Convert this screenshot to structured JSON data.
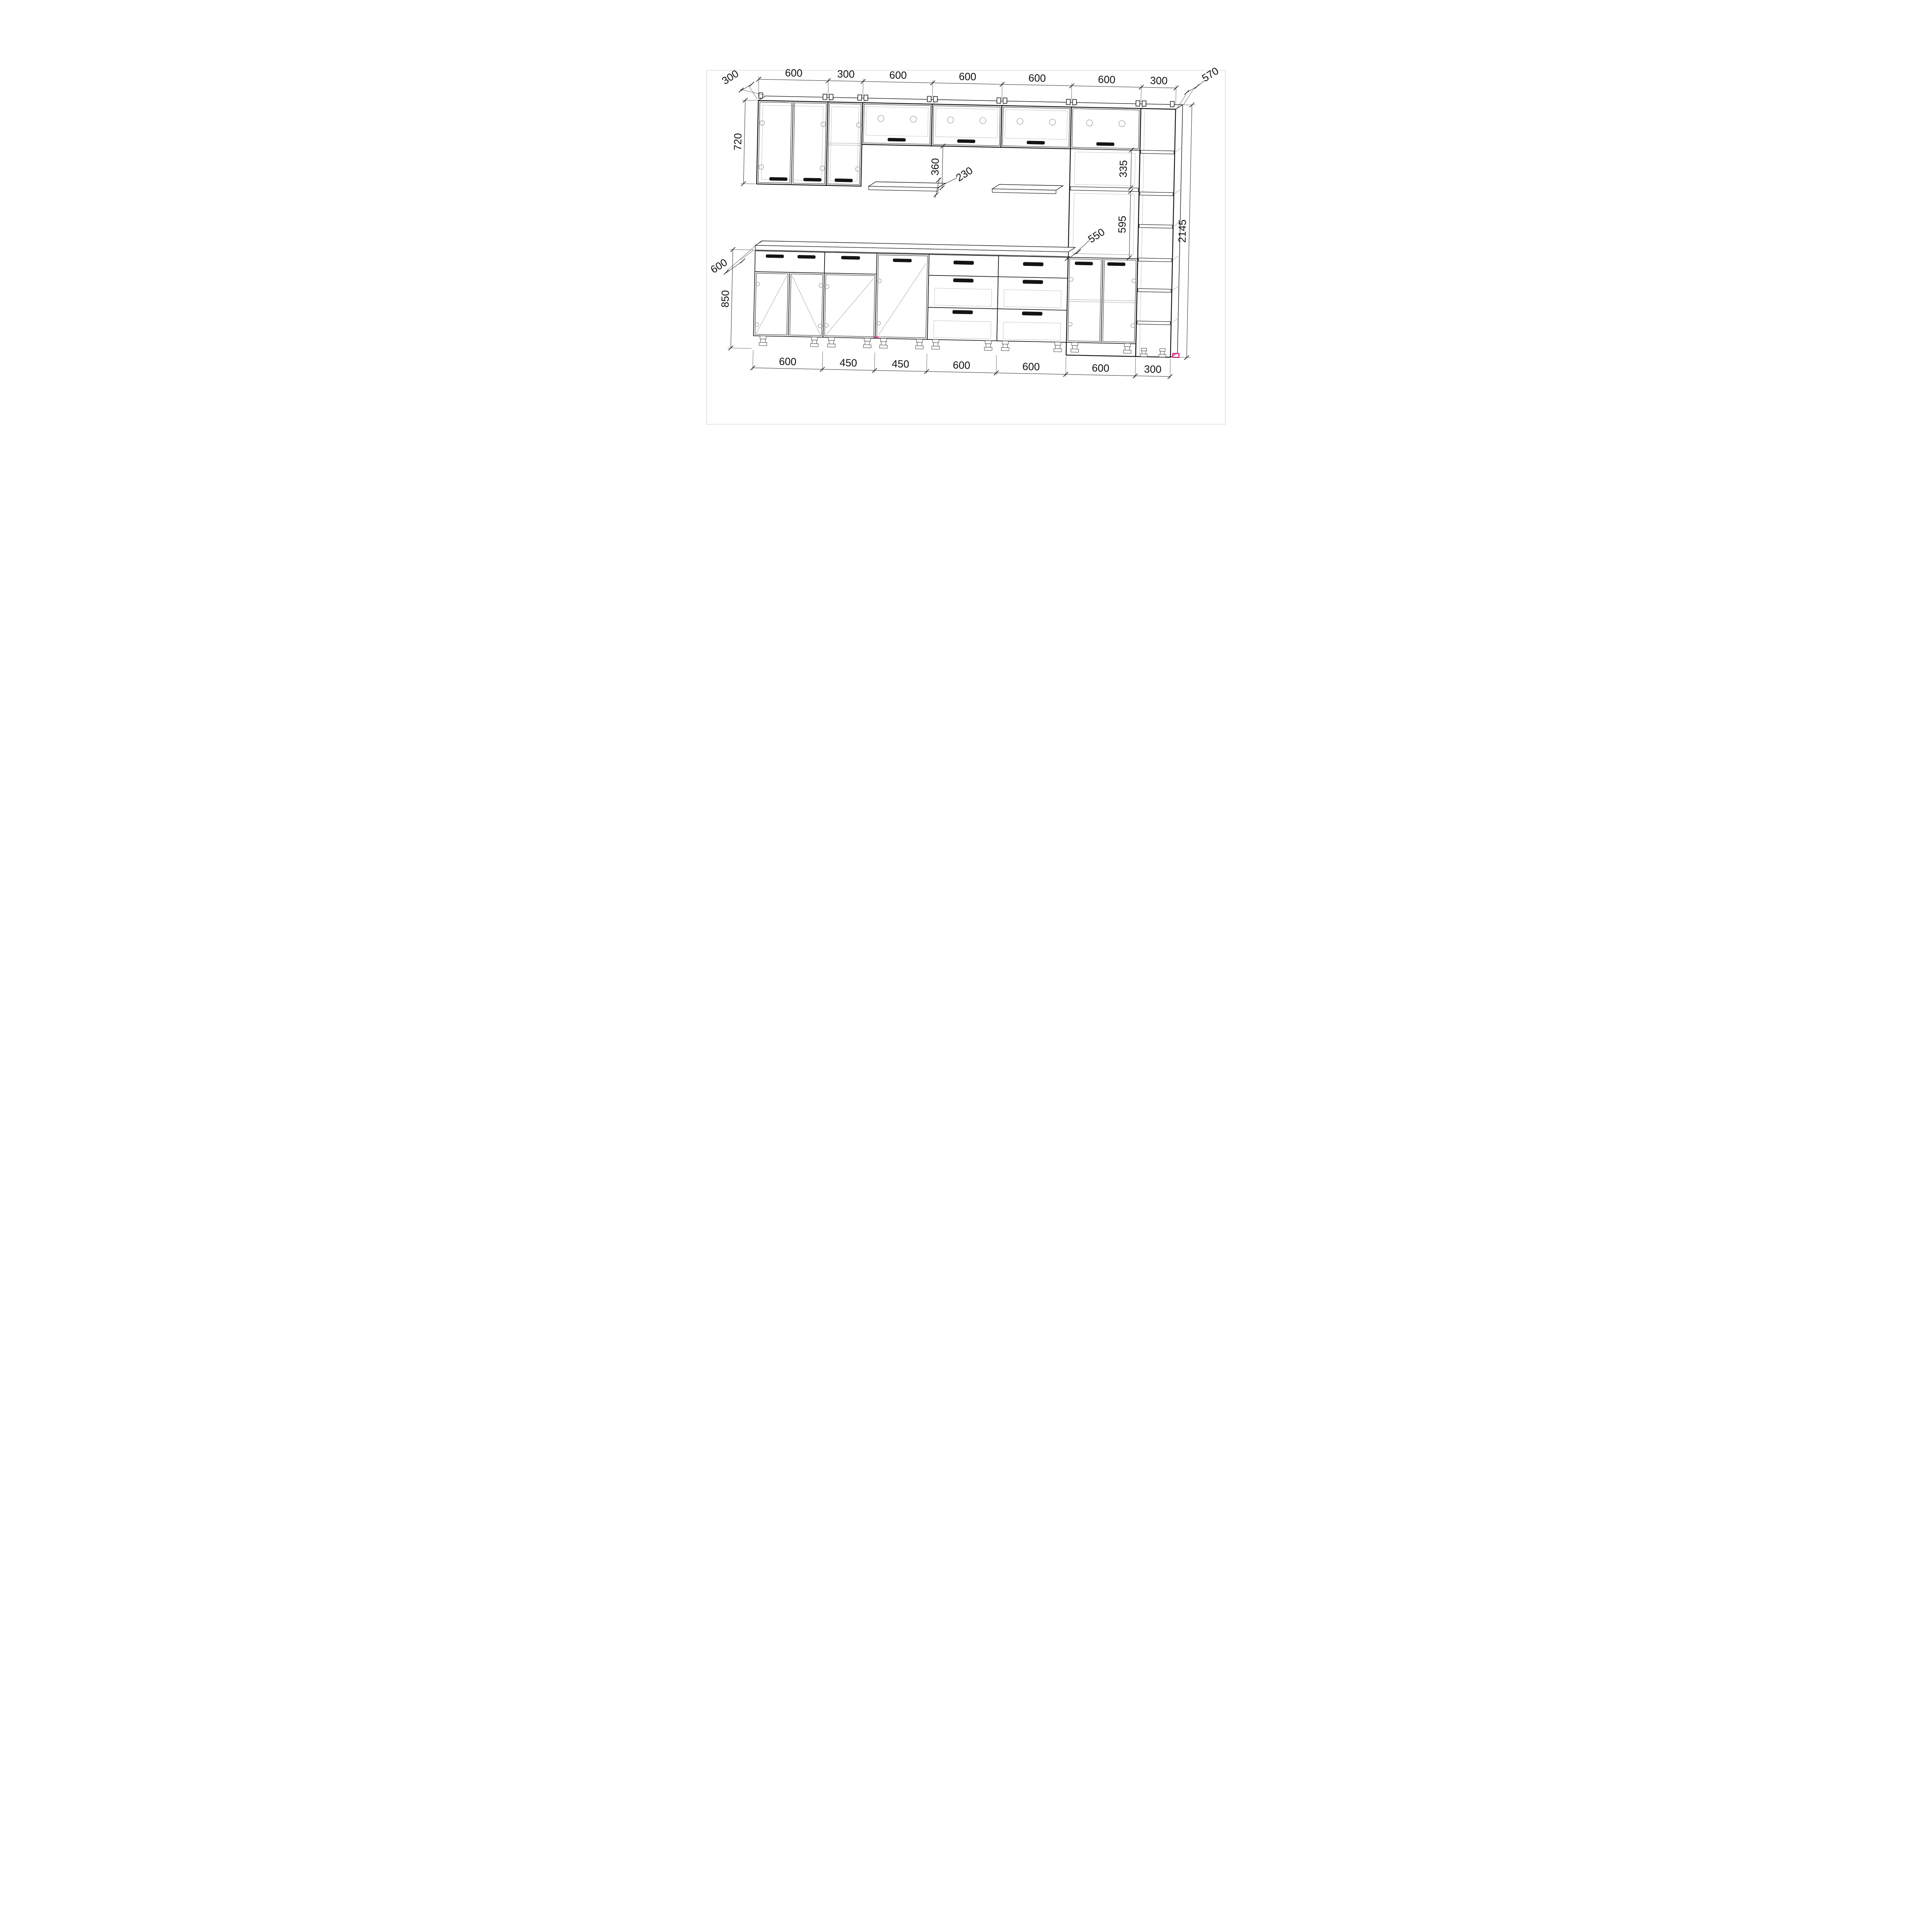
{
  "drawing": {
    "kind": "kitchen-cabinet-set-technical-drawing",
    "dims_top": [
      "600",
      "300",
      "600",
      "600",
      "600",
      "600",
      "300"
    ],
    "dims_bottom": [
      "600",
      "450",
      "450",
      "600",
      "600",
      "600",
      "300"
    ],
    "dim_wall_depth": "300",
    "dim_wall_height": "720",
    "dim_base_depth": "600",
    "dim_base_height": "850",
    "dim_total_height": "2145",
    "dim_tall_depth": "570",
    "dim_shelf_depth": "230",
    "dim_flap_to_shelf": "360",
    "dim_microwave_niche": "335",
    "dim_oven_niche_depth": "550",
    "dim_oven_door": "595",
    "colors": {
      "line": "#1a1a1a",
      "secondary": "#9a9a9a",
      "accent_magenta": "#e5187a",
      "sheet_frame": "#c9d4d4",
      "background": "#ffffff"
    }
  }
}
